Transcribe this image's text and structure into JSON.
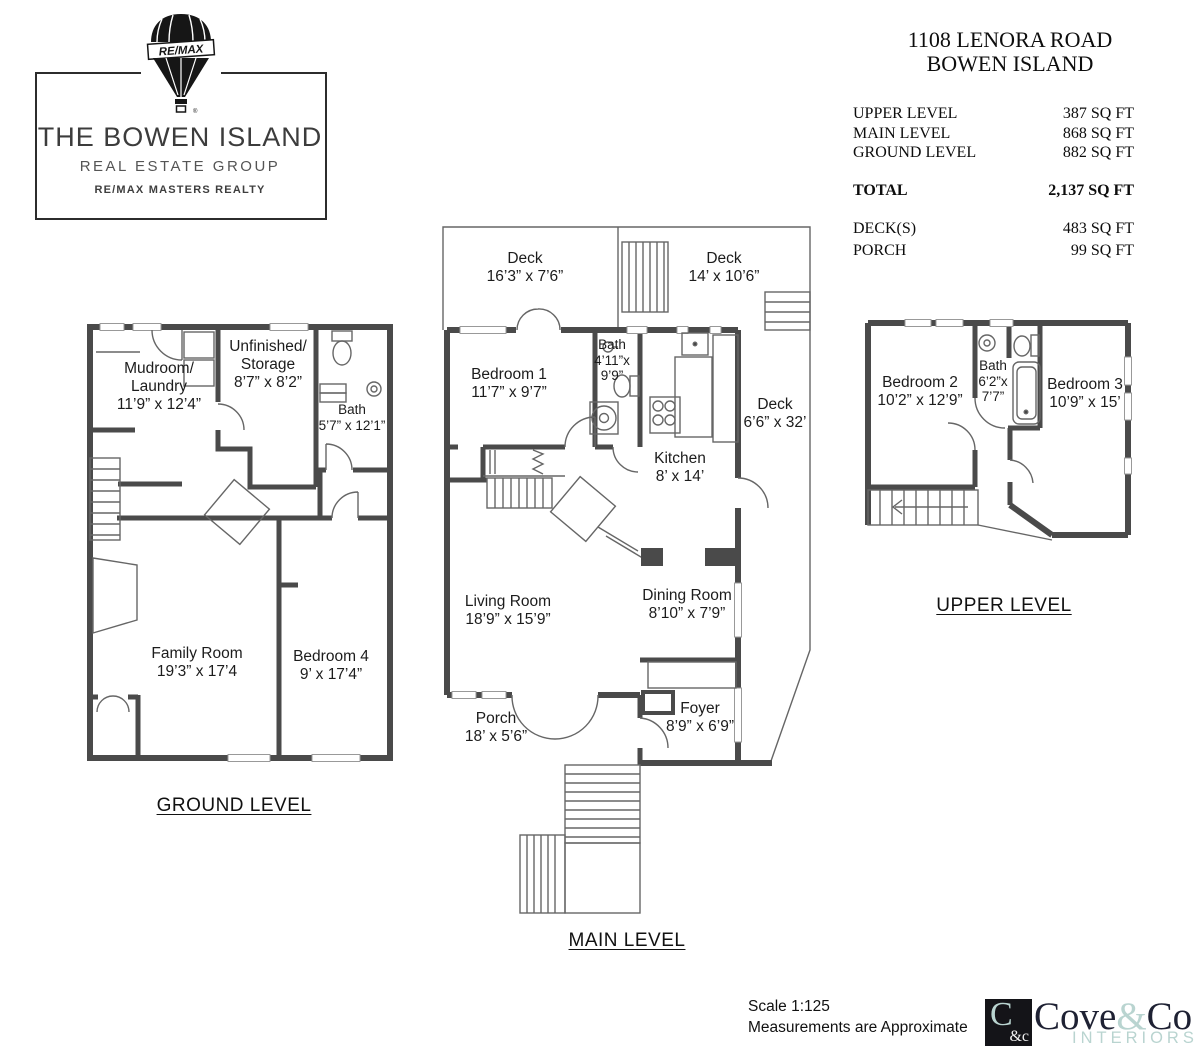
{
  "colors": {
    "wall": "#4a4a4a",
    "thin_line": "#666666",
    "text": "#1b1b1b",
    "teal": "#b9d4d0",
    "navy": "#1e2133"
  },
  "remax_logo": {
    "balloon_text": "RE/MAX",
    "org_name": "THE BOWEN ISLAND",
    "org_sub": "REAL ESTATE GROUP",
    "org_brand": "RE/MAX MASTERS REALTY"
  },
  "header": {
    "address_line1": "1108 LENORA ROAD",
    "address_line2": "BOWEN ISLAND"
  },
  "area_table": {
    "rows": [
      {
        "label": "UPPER LEVEL",
        "value": "387 SQ FT"
      },
      {
        "label": "MAIN LEVEL",
        "value": "868 SQ FT"
      },
      {
        "label": "GROUND LEVEL",
        "value": "882 SQ FT"
      }
    ],
    "total": {
      "label": "TOTAL",
      "value": "2,137 SQ FT"
    },
    "extras": [
      {
        "label": "DECK(S)",
        "value": "483 SQ FT"
      },
      {
        "label": "PORCH",
        "value": "99 SQ FT"
      }
    ]
  },
  "plans": {
    "ground": {
      "title": "GROUND LEVEL",
      "rooms": [
        {
          "id": "mudroom-laundry",
          "lines": [
            "Mudroom/",
            "Laundry",
            "11’9” x 12’4”"
          ]
        },
        {
          "id": "unfinished-storage",
          "lines": [
            "Unfinished/",
            "Storage",
            "8’7” x 8’2”"
          ]
        },
        {
          "id": "bath-ground",
          "lines": [
            "Bath",
            "5’7” x 12’1”"
          ]
        },
        {
          "id": "family-room",
          "lines": [
            "Family Room",
            "19’3” x 17’4"
          ]
        },
        {
          "id": "bedroom-4",
          "lines": [
            "Bedroom 4",
            "9’ x 17’4”"
          ]
        }
      ]
    },
    "main": {
      "title": "MAIN LEVEL",
      "rooms": [
        {
          "id": "deck-left",
          "lines": [
            "Deck",
            "16’3” x 7’6”"
          ]
        },
        {
          "id": "deck-right",
          "lines": [
            "Deck",
            "14’ x 10’6”"
          ]
        },
        {
          "id": "bedroom-1",
          "lines": [
            "Bedroom 1",
            "11’7” x 9’7”"
          ]
        },
        {
          "id": "bath-main",
          "lines": [
            "Bath",
            "4’11”x",
            "9’9”"
          ]
        },
        {
          "id": "kitchen",
          "lines": [
            "Kitchen",
            "8’ x 14’"
          ]
        },
        {
          "id": "deck-side",
          "lines": [
            "Deck",
            "6’6” x 32’"
          ]
        },
        {
          "id": "living-room",
          "lines": [
            "Living Room",
            "18’9” x 15’9”"
          ]
        },
        {
          "id": "dining-room",
          "lines": [
            "Dining Room",
            "8’10” x 7’9”"
          ]
        },
        {
          "id": "porch",
          "lines": [
            "Porch",
            "18’ x 5’6”"
          ]
        },
        {
          "id": "foyer",
          "lines": [
            "Foyer",
            "8’9” x 6’9”"
          ]
        }
      ]
    },
    "upper": {
      "title": "UPPER LEVEL",
      "rooms": [
        {
          "id": "bedroom-2",
          "lines": [
            "Bedroom 2",
            "10’2” x 12’9”"
          ]
        },
        {
          "id": "bath-upper",
          "lines": [
            "Bath",
            "6’2”x",
            "7’7”"
          ]
        },
        {
          "id": "bedroom-3",
          "lines": [
            "Bedroom 3",
            "10’9” x 15’"
          ]
        }
      ]
    }
  },
  "footer": {
    "scale": "Scale 1:125",
    "note": "Measurements are Approximate"
  },
  "coveco_logo": {
    "mark_main": "C",
    "mark_sub": "&c",
    "word_part1": "Cove",
    "word_amp": "&",
    "word_part2": "Co",
    "tagline": "INTERIORS"
  }
}
